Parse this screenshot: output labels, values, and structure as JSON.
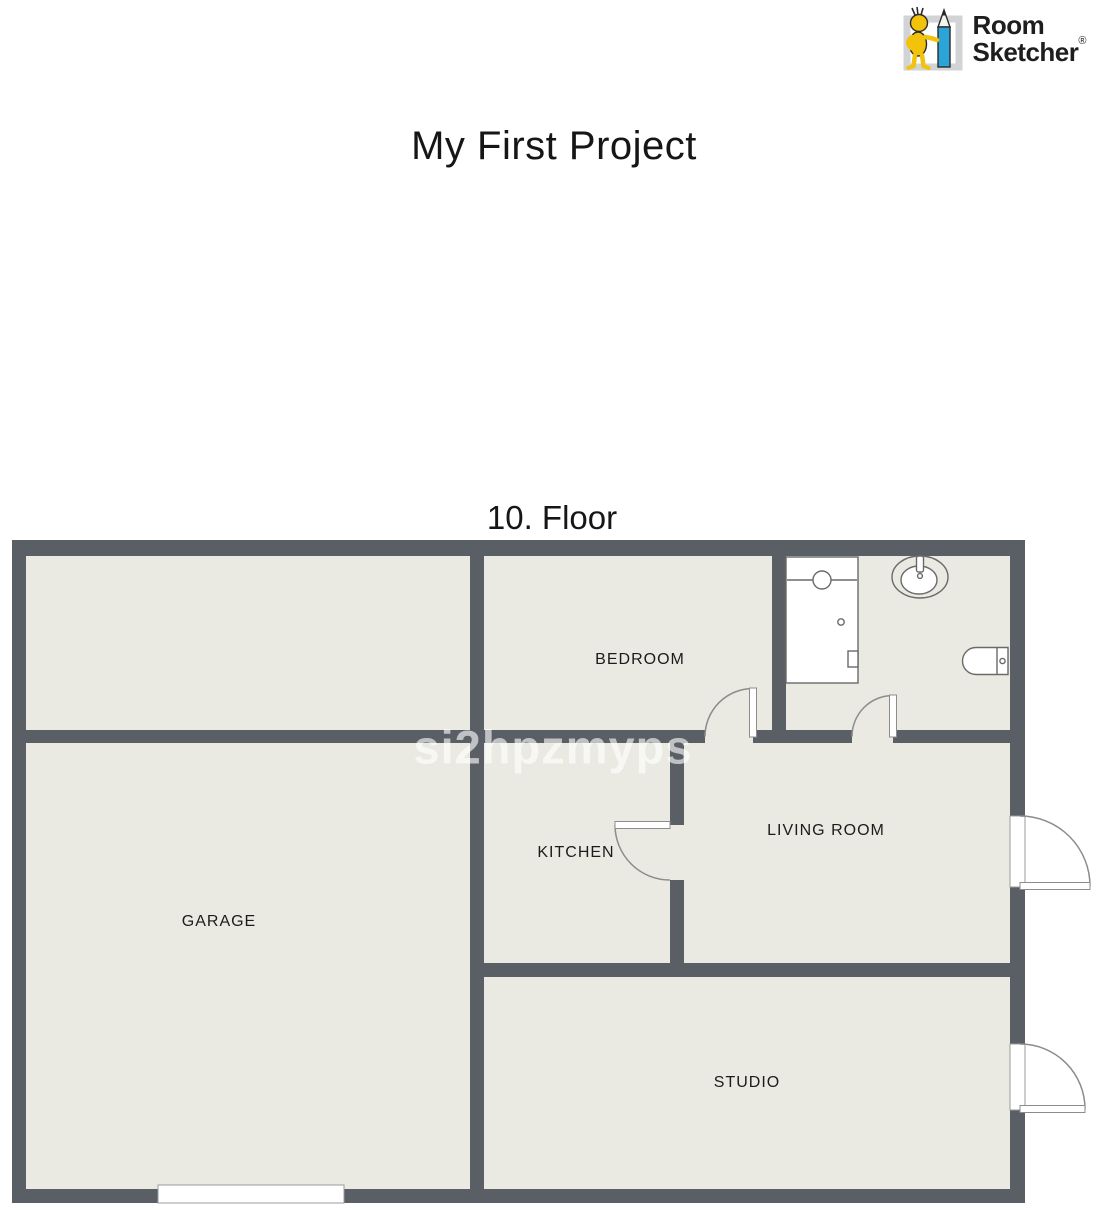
{
  "brand": {
    "line1": "Room",
    "line2": "Sketcher",
    "registered": "®",
    "colors": {
      "figure_yellow": "#f3c20a",
      "pencil_blue": "#2ba5d8",
      "frame_gray": "#d2d3d5",
      "text": "#1e1e1e"
    }
  },
  "header": {
    "title": "My First Project"
  },
  "plan": {
    "floor_label": "10. Floor",
    "watermark": "si2hpzmyps",
    "colors": {
      "wall": "#5a5e65",
      "floor": "#eaeae2",
      "exterior": "#ffffff",
      "door_stroke": "#8c8c8c",
      "fixture_stroke": "#6a6a6a"
    },
    "rooms": [
      {
        "id": "bedroom",
        "name": "BEDROOM"
      },
      {
        "id": "kitchen",
        "name": "KITCHEN"
      },
      {
        "id": "living-room",
        "name": "LIVING ROOM"
      },
      {
        "id": "garage",
        "name": "GARAGE"
      },
      {
        "id": "studio",
        "name": "STUDIO"
      }
    ],
    "unlabeled_areas": [
      "top-left-room",
      "bathroom"
    ],
    "fixtures": [
      "shower",
      "sink",
      "toilet"
    ],
    "doors": [
      "bedroom-door",
      "bathroom-door",
      "kitchen-door",
      "living-room-exterior-door",
      "studio-exterior-door",
      "garage-opening"
    ]
  }
}
